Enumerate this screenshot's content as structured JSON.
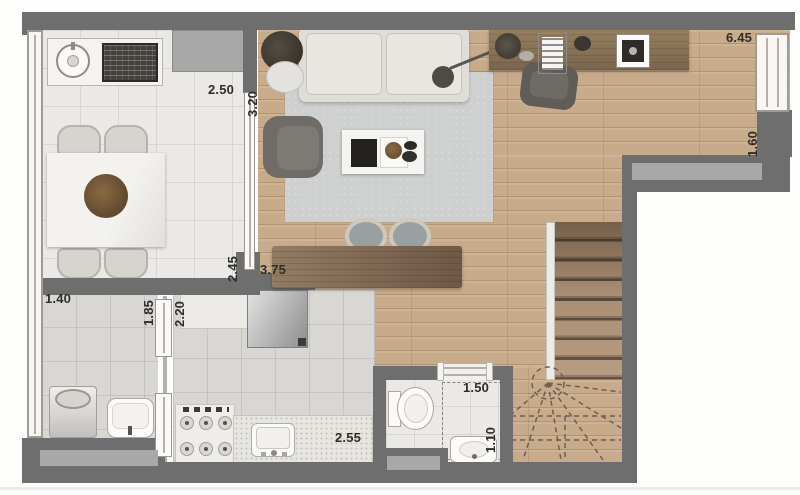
{
  "dims": {
    "dining_width": "2.50",
    "living_depth": "3.20",
    "office_width": "6.45",
    "office_depth": "1.60",
    "dining_length": "2.45",
    "living_width": "3.75",
    "laundry_width": "1.40",
    "laundry_length": "1.85",
    "kitchen_run": "2.20",
    "bath_width": "1.50",
    "counter_run": "2.55",
    "bath_depth": "1.10"
  },
  "colors": {
    "wall": "#6e6e6e",
    "wall-inset": "#a8a8a8",
    "wood": "#c8ab8b",
    "wood-dark": "#6b5848",
    "tile-light": "#eae9e5",
    "tile-mid": "#d9d7d3",
    "rug": "#cdd0cf",
    "fixture-white": "#f4f3f0",
    "label": "#2f2d2a"
  }
}
